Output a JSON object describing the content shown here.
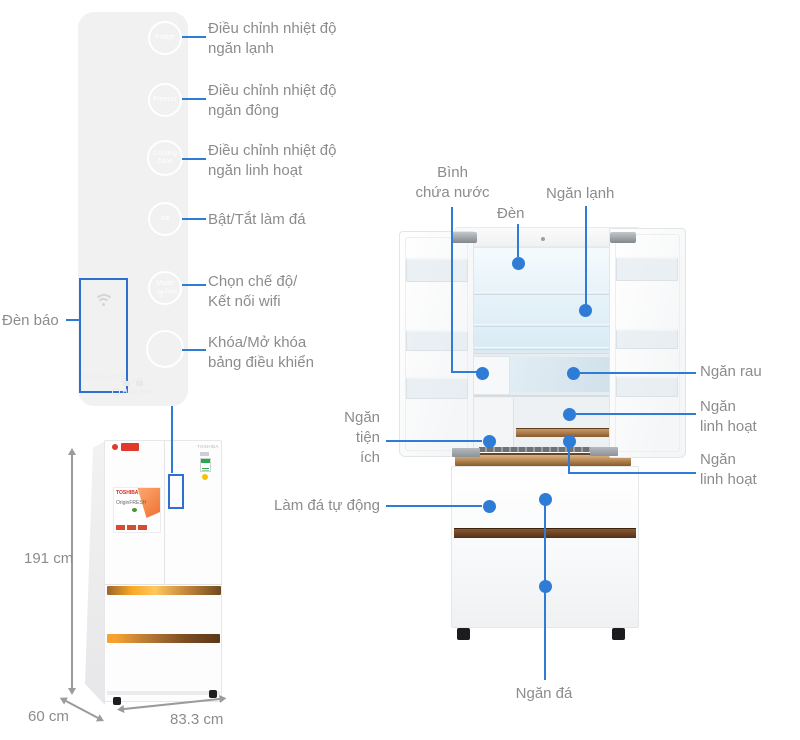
{
  "colors": {
    "accent_blue": "#2e7cd6",
    "outline_blue": "#2e6fd0",
    "label_gray": "#8c8c8c"
  },
  "control_panel": {
    "buttons": [
      {
        "label_lines": [
          "Fridge"
        ],
        "desc_lines": [
          "Điều chỉnh nhiệt độ",
          "ngăn lạnh"
        ]
      },
      {
        "label_lines": [
          "Freezer"
        ],
        "desc_lines": [
          "Điều chỉnh nhiệt độ",
          "ngăn đông"
        ]
      },
      {
        "label_lines": [
          "Cooling",
          "Zone"
        ],
        "desc_lines": [
          "Điều chỉnh nhiệt độ",
          "ngăn linh hoạt"
        ]
      },
      {
        "label_lines": [
          "Ice"
        ],
        "desc_lines": [
          "Bật/Tắt làm đá"
        ]
      },
      {
        "label_lines": [
          "Mode",
          "3sec"
        ],
        "desc_lines": [
          "Chọn chế độ/",
          "Kết nối wifi"
        ]
      },
      {
        "label_lines": [
          ""
        ],
        "desc_lines": [
          "Khóa/Mở khóa",
          "bảng điều khiển"
        ]
      }
    ],
    "indicator": {
      "label": "Đèn báo",
      "status": "Sensing OFF"
    },
    "footer": {
      "lock_separator": "/",
      "hold_text": "Hold 3sec"
    }
  },
  "dimensions": {
    "height": "191 cm",
    "depth": "60 cm",
    "width": "83.3 cm"
  },
  "small_fridge": {
    "door_brand": "TOSHIBA",
    "poster_brand": "TOSHIBA",
    "poster_title": "OriginFRESH"
  },
  "fridge_open": {
    "labels": {
      "water_tank": [
        "Bình",
        "chứa nước"
      ],
      "light": "Đèn",
      "cooler": "Ngăn lạnh",
      "veg": "Ngăn rau",
      "flex1": [
        "Ngăn",
        "linh hoạt"
      ],
      "flex2": [
        "Ngăn",
        "linh hoạt"
      ],
      "utility": [
        "Ngăn",
        "tiện",
        "ích"
      ],
      "auto_ice": "Làm đá tự động",
      "freezer": "Ngăn đá"
    }
  }
}
